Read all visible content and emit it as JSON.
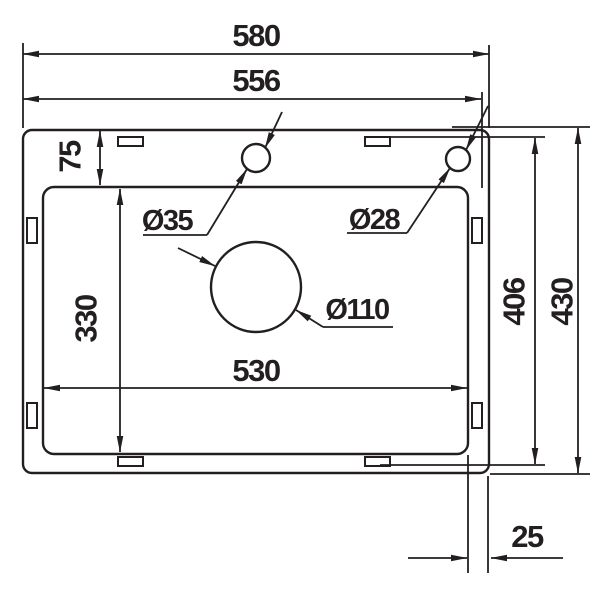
{
  "drawing": {
    "background_color": "#ffffff",
    "line_color": "#231f20",
    "dimensions": {
      "overall_width": "580",
      "top_width": "556",
      "rim_top": "75",
      "bowl_length": "330",
      "bowl_width": "530",
      "clip_span": "406",
      "overall_depth": "430",
      "rim_side": "25"
    },
    "holes": {
      "faucet_hole": "Ø35",
      "small_hole": "Ø28",
      "drain_hole": "Ø110"
    }
  }
}
